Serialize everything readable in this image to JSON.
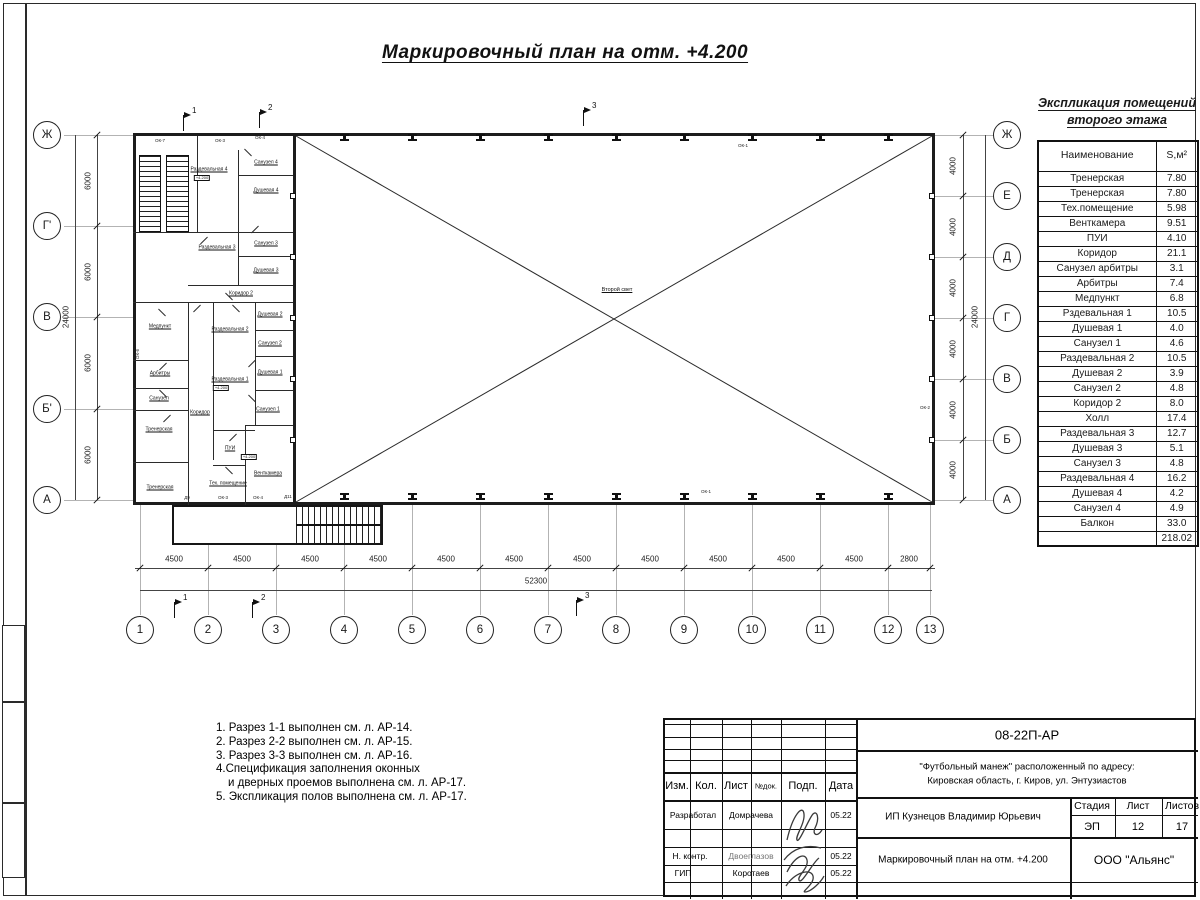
{
  "title": "Маркировочный план на отм. +4.200",
  "plan": {
    "hall_label": "Второй свет",
    "elevation_mark": "+4.200",
    "grid_cols": [
      "1",
      "2",
      "3",
      "4",
      "5",
      "6",
      "7",
      "8",
      "9",
      "10",
      "11",
      "12",
      "13"
    ],
    "grid_rows_left": [
      "Ж",
      "Г'",
      "В",
      "Б'",
      "А"
    ],
    "grid_rows_right": [
      "Ж",
      "Е",
      "Д",
      "Г",
      "В",
      "Б",
      "А"
    ],
    "col_spans": [
      "4500",
      "4500",
      "4500",
      "4500",
      "4500",
      "4500",
      "4500",
      "4500",
      "4500",
      "4500",
      "4500",
      "2800"
    ],
    "total_width": "52300",
    "row_spans_left": [
      "6000",
      "6000",
      "6000",
      "6000"
    ],
    "row_spans_right": [
      "4000",
      "4000",
      "4000",
      "4000",
      "4000",
      "4000"
    ],
    "total_height": "24000",
    "section_markers": [
      "1",
      "2",
      "3"
    ],
    "room_labels": [
      {
        "text": "Раздевальная 4",
        "x": 209,
        "y": 170
      },
      {
        "text": "Санузел 4",
        "x": 266,
        "y": 163
      },
      {
        "text": "Душевая 4",
        "x": 266,
        "y": 191
      },
      {
        "text": "Санузел 3",
        "x": 266,
        "y": 244
      },
      {
        "text": "Раздевальная 3",
        "x": 217,
        "y": 248
      },
      {
        "text": "Душевая 3",
        "x": 266,
        "y": 271
      },
      {
        "text": "Коридор 2",
        "x": 241,
        "y": 294
      },
      {
        "text": "Медпункт",
        "x": 160,
        "y": 327
      },
      {
        "text": "Душевая 2",
        "x": 270,
        "y": 315
      },
      {
        "text": "Раздевальная 2",
        "x": 230,
        "y": 330
      },
      {
        "text": "Санузел 2",
        "x": 270,
        "y": 344
      },
      {
        "text": "Арбитры",
        "x": 160,
        "y": 374
      },
      {
        "text": "Душевая 1",
        "x": 270,
        "y": 373
      },
      {
        "text": "Раздевальная 1",
        "x": 230,
        "y": 380
      },
      {
        "text": "Санузел",
        "x": 159,
        "y": 399
      },
      {
        "text": "Санузел 1",
        "x": 268,
        "y": 410
      },
      {
        "text": "Коридор",
        "x": 200,
        "y": 413
      },
      {
        "text": "Тренерская",
        "x": 159,
        "y": 430
      },
      {
        "text": "ПУИ",
        "x": 230,
        "y": 449
      },
      {
        "text": "Венткамера",
        "x": 268,
        "y": 474
      },
      {
        "text": "Тех. помещение",
        "x": 228,
        "y": 484
      },
      {
        "text": "Тренерская",
        "x": 160,
        "y": 488
      }
    ],
    "opening_labels": [
      {
        "text": "ОК-7",
        "x": 160,
        "y": 141
      },
      {
        "text": "ОК-3",
        "x": 220,
        "y": 141
      },
      {
        "text": "ОК-4",
        "x": 260,
        "y": 138
      },
      {
        "text": "ОК-1",
        "x": 743,
        "y": 146
      },
      {
        "text": "ОК-2",
        "x": 925,
        "y": 408
      },
      {
        "text": "ОК-6",
        "x": 138,
        "y": 354,
        "v": true
      },
      {
        "text": "Д9",
        "x": 187,
        "y": 498
      },
      {
        "text": "ОК-3",
        "x": 223,
        "y": 498
      },
      {
        "text": "ОК-4",
        "x": 258,
        "y": 498
      },
      {
        "text": "Д11",
        "x": 288,
        "y": 497
      },
      {
        "text": "ОК-1",
        "x": 706,
        "y": 492
      }
    ]
  },
  "schedule": {
    "title_line1": "Экспликация помещений",
    "title_line2": "второго этажа",
    "col_name": "Наименование",
    "col_area": "S,м²",
    "rows": [
      {
        "name": "Тренерская",
        "area": "7.80"
      },
      {
        "name": "Тренерская",
        "area": "7.80"
      },
      {
        "name": "Тех.помещение",
        "area": "5.98"
      },
      {
        "name": "Венткамера",
        "area": "9.51"
      },
      {
        "name": "ПУИ",
        "area": "4.10"
      },
      {
        "name": "Коридор",
        "area": "21.1"
      },
      {
        "name": "Санузел арбитры",
        "area": "3.1"
      },
      {
        "name": "Арбитры",
        "area": "7.4"
      },
      {
        "name": "Медпункт",
        "area": "6.8"
      },
      {
        "name": "Рздевальная 1",
        "area": "10.5"
      },
      {
        "name": "Душевая 1",
        "area": "4.0"
      },
      {
        "name": "Санузел 1",
        "area": "4.6"
      },
      {
        "name": "Раздевальная 2",
        "area": "10.5"
      },
      {
        "name": "Душевая 2",
        "area": "3.9"
      },
      {
        "name": "Санузел 2",
        "area": "4.8"
      },
      {
        "name": "Коридор 2",
        "area": "8.0"
      },
      {
        "name": "Холл",
        "area": "17.4"
      },
      {
        "name": "Раздевальная 3",
        "area": "12.7"
      },
      {
        "name": "Душевая 3",
        "area": "5.1"
      },
      {
        "name": "Санузел 3",
        "area": "4.8"
      },
      {
        "name": "Раздевальная 4",
        "area": "16.2"
      },
      {
        "name": "Душевая 4",
        "area": "4.2"
      },
      {
        "name": "Санузел 4",
        "area": "4.9"
      },
      {
        "name": "Балкон",
        "area": "33.0"
      }
    ],
    "total": "218.02"
  },
  "notes": [
    {
      "text": "1. Разрез 1-1 выполнен см. л. АР-14.",
      "indent": false
    },
    {
      "text": "2. Разрез 2-2 выполнен см. л. АР-15.",
      "indent": false
    },
    {
      "text": "3. Разрез 3-3 выполнен см. л. АР-16.",
      "indent": false
    },
    {
      "text": "4.Спецификация заполнения оконных",
      "indent": false
    },
    {
      "text": "и дверных проемов выполнена см. л. АР-17.",
      "indent": true
    },
    {
      "text": "5. Экспликация полов выполнена см. л. АР-17.",
      "indent": false
    }
  ],
  "stamp": {
    "doc_number": "08-22П-АР",
    "project_line1": "\"Футбольный манеж\" расположенный по адресу:",
    "project_line2": "Кировская область, г. Киров, ул. Энтузиастов",
    "client": "ИП Кузнецов Владимир Юрьевич",
    "sheet_title": "Маркировочный план на отм. +4.200",
    "company": "ООО \"Альянс\"",
    "header_cols": [
      "Изм.",
      "Кол.",
      "Лист",
      "№док.",
      "Подп.",
      "Дата"
    ],
    "stage_label": "Стадия",
    "sheet_label": "Лист",
    "sheets_label": "Листов",
    "stage_value": "ЭП",
    "sheet_value": "12",
    "sheets_value": "17",
    "roles": [
      {
        "role": "Разработал",
        "name": "Домрачева",
        "date": "05.22"
      },
      {
        "role": "Н. контр.",
        "name": "Двоеглазов",
        "date": "05.22"
      },
      {
        "role": "ГИП",
        "name": "Коротаев",
        "date": "05.22"
      }
    ]
  }
}
